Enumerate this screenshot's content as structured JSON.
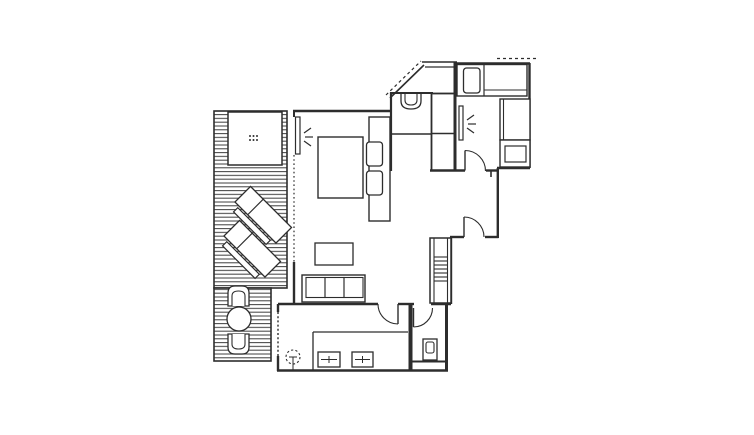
{
  "meta": {
    "type": "architectural-floor-plan",
    "canvas": {
      "width": 754,
      "height": 435
    },
    "visible_text": ""
  },
  "colors": {
    "background": "#ffffff",
    "line": "#2d2d2d",
    "deck_stripe": "#3d3d3d"
  },
  "plan": {
    "deck": {
      "items": [
        "patio-table",
        "lounger",
        "lounger",
        "patio-chair",
        "round-table",
        "patio-chair"
      ],
      "style": "horizontal-plank-stripes"
    },
    "main_bedroom": {
      "items": [
        "wall-mirror",
        "light-sparkle-symbol",
        "double-bed",
        "pillow",
        "pillow",
        "sliding-door-dotted"
      ]
    },
    "bath_niche": {
      "items": [
        "washbasin",
        "wardrobe"
      ]
    },
    "bedroom_2": {
      "items": [
        "single-bed",
        "pillow",
        "desk",
        "nightstand",
        "wall-mirror",
        "light-sparkle-symbol",
        "door-arc"
      ]
    },
    "hallway": {
      "items": [
        "door-arc"
      ]
    },
    "living_room": {
      "items": [
        "coffee-table",
        "sofa-3-seat",
        "stairs"
      ]
    },
    "kitchen": {
      "items": [
        "counter",
        "sink",
        "sink",
        "ceiling-lamp-symbol",
        "door-arc",
        "window-dashed"
      ]
    },
    "wc": {
      "items": [
        "toilet",
        "door-arc"
      ]
    },
    "roof": {
      "items": [
        "dashed-roof-line-diagonal",
        "dashed-roof-line-top"
      ]
    }
  }
}
